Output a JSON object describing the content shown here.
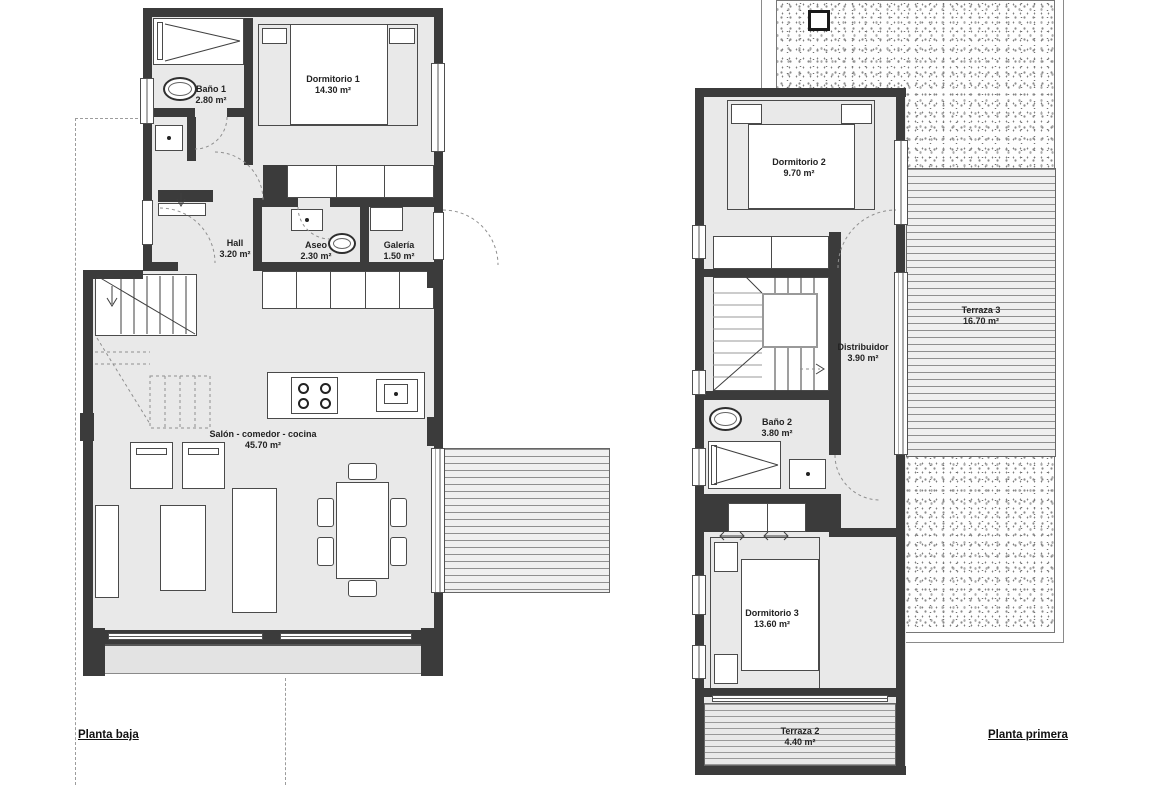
{
  "ground_floor": {
    "title": "Planta baja",
    "rooms": [
      {
        "name": "Baño 1",
        "area": "2.80 m²"
      },
      {
        "name": "Dormitorio 1",
        "area": "14.30 m²"
      },
      {
        "name": "Hall",
        "area": "3.20 m²"
      },
      {
        "name": "Aseo",
        "area": "2.30 m²"
      },
      {
        "name": "Galería",
        "area": "1.50 m²"
      },
      {
        "name": "Salón - comedor - cocina",
        "area": "45.70 m²"
      }
    ]
  },
  "first_floor": {
    "title": "Planta primera",
    "rooms": [
      {
        "name": "Dormitorio 2",
        "area": "9.70 m²"
      },
      {
        "name": "Terraza 3",
        "area": "16.70 m²"
      },
      {
        "name": "Distribuidor",
        "area": "3.90 m²"
      },
      {
        "name": "Baño 2",
        "area": "3.80 m²"
      },
      {
        "name": "Dormitorio 3",
        "area": "13.60 m²"
      },
      {
        "name": "Terraza 2",
        "area": "4.40 m²"
      }
    ]
  },
  "colors": {
    "wall": "#3b3b3b",
    "floor": "#e9e9e9",
    "paper": "#ffffff",
    "deck_line": "#8f8f8f",
    "dashed_line": "#9c9c9c"
  }
}
